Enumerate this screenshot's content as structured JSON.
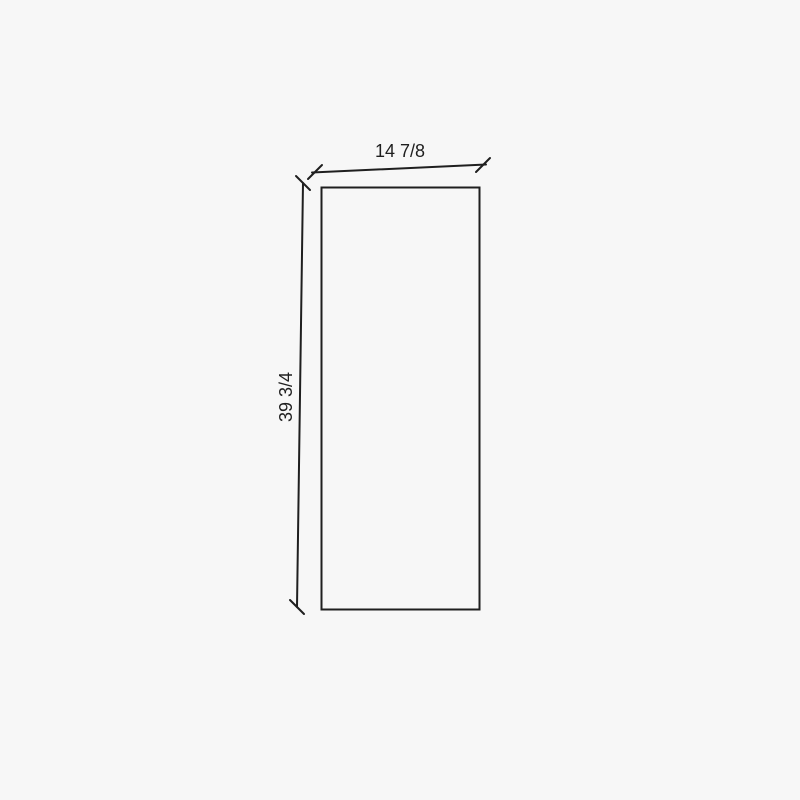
{
  "drawing": {
    "type": "panel-elevation-dimension-drawing",
    "width_label": "14 7/8",
    "height_label": "39 3/4",
    "colors": {
      "background": "#f7f7f7",
      "line": "#1f1f1f",
      "text": "#1f1f1f"
    }
  }
}
